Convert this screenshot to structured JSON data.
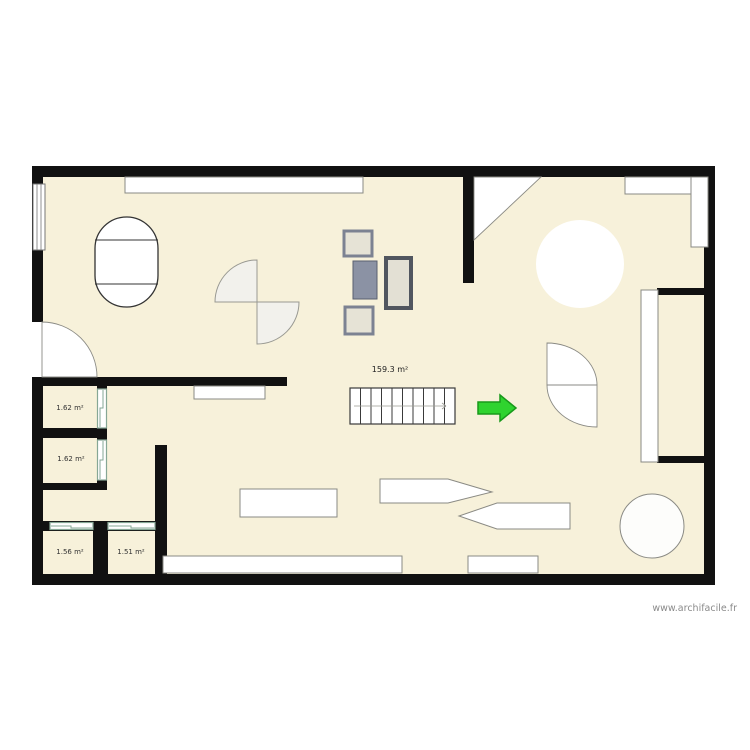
{
  "plan": {
    "watermark": "www.archifacile.fr",
    "main_area_label": "159.3 m²",
    "room_labels": {
      "room1": "1.62 m²",
      "room2": "1.62 m²",
      "room3": "1.56 m²",
      "room4": "1.51 m²"
    }
  },
  "colors": {
    "floor": "#f7f1da",
    "wall": "#111111",
    "green_arrow": "#2fd32f"
  }
}
